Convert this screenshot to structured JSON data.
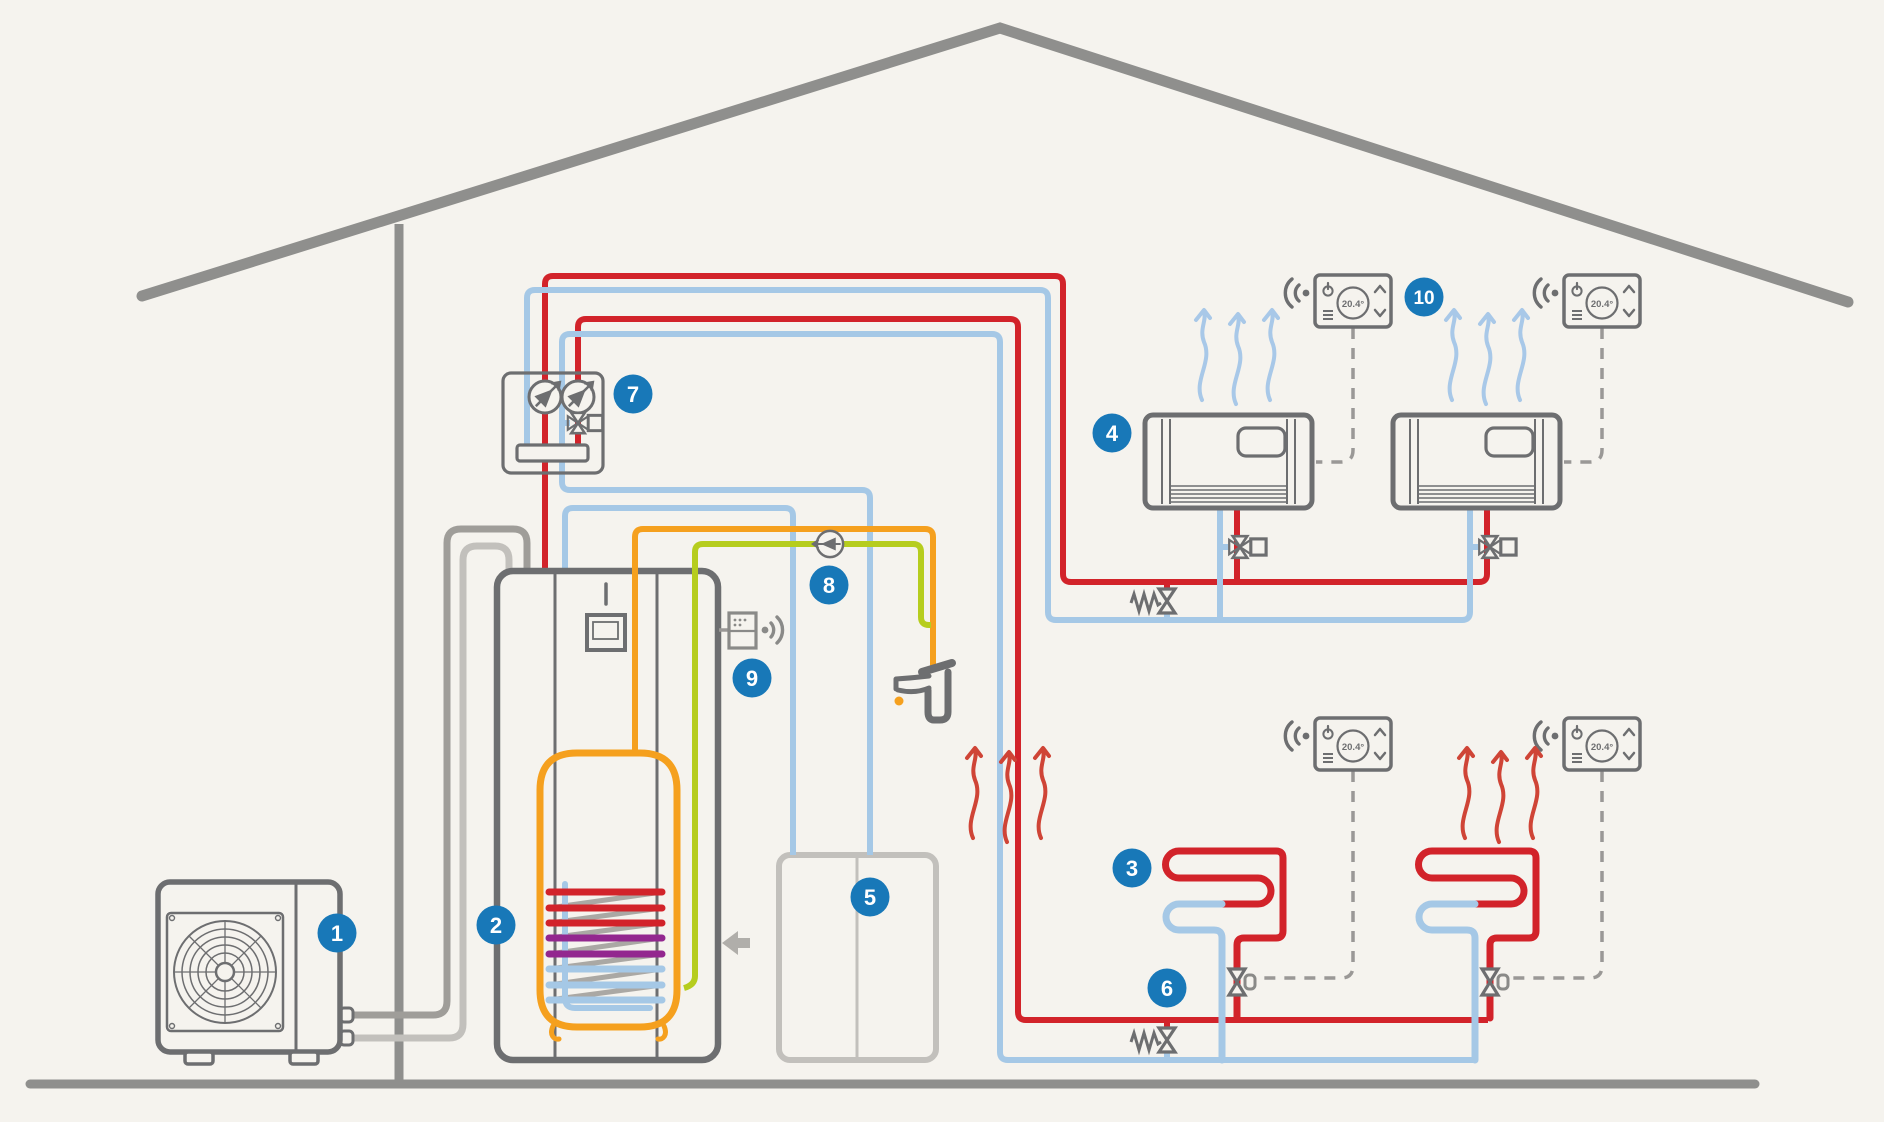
{
  "diagram": {
    "title_hidden": "",
    "thermostat": {
      "display": "20.4°"
    },
    "badges": [
      {
        "label": "1",
        "component": "outdoor-heat-pump-unit"
      },
      {
        "label": "2",
        "component": "indoor-unit-dhw-tank"
      },
      {
        "label": "3",
        "component": "underfloor-heating-loop"
      },
      {
        "label": "4",
        "component": "fan-coil-unit"
      },
      {
        "label": "5",
        "component": "ventilation-cabinet"
      },
      {
        "label": "6",
        "component": "differential-bypass-valve"
      },
      {
        "label": "7",
        "component": "pump-and-mixing-group"
      },
      {
        "label": "8",
        "component": "dhw-circulation-pump"
      },
      {
        "label": "9",
        "component": "wireless-gateway-module"
      },
      {
        "label": "10",
        "component": "room-thermostat"
      }
    ],
    "colors": {
      "background": "#f5f3ee",
      "house": "#8f8f8d",
      "outline": "#6d6e70",
      "supply_red": "#d2232a",
      "return_blue": "#a5c8e6",
      "dhw_orange": "#f5a01e",
      "recirc_green": "#b6cd1e",
      "coil_purple": "#93278f",
      "pipe_gray_dark": "#9f9d99",
      "pipe_gray_light": "#c2c0bc",
      "dashed_control": "#9a9896",
      "badge_blue": "#1878b8",
      "arrow_warm": "#cf4436",
      "arrow_cool": "#a8c8e8"
    }
  }
}
